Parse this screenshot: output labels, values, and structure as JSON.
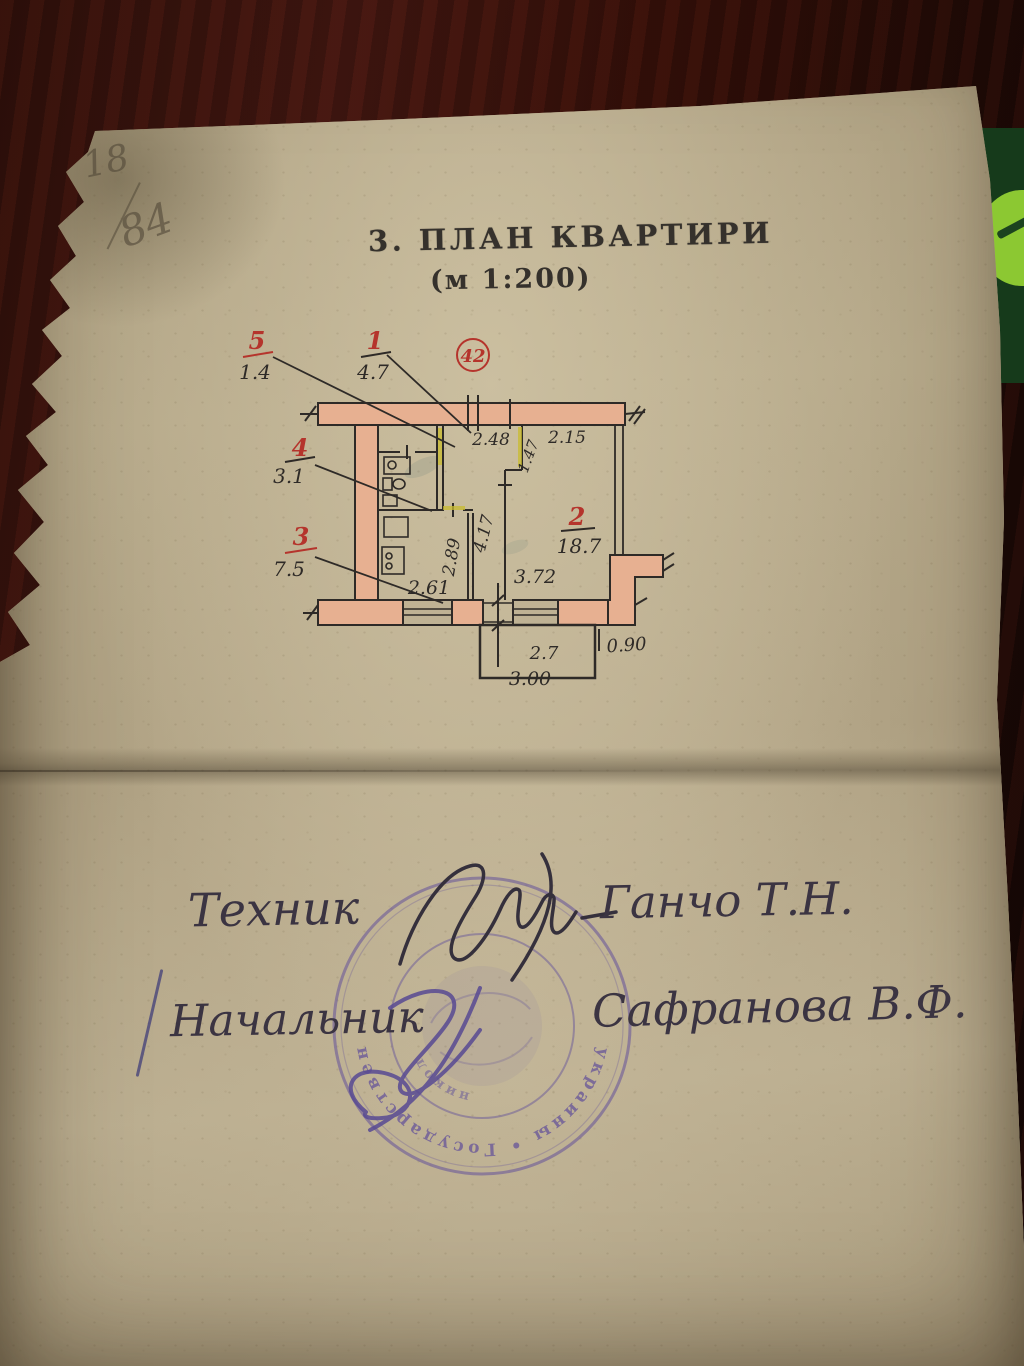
{
  "heading": {
    "title": "3. ПЛАН КВАРТИРИ",
    "scale": "(м 1:200)"
  },
  "corner_note": {
    "top": "18",
    "bottom": "84"
  },
  "plan": {
    "flat_number": "42",
    "rooms": [
      {
        "num": "5",
        "area": "1.4"
      },
      {
        "num": "1",
        "area": "4.7"
      },
      {
        "num": "4",
        "area": "3.1"
      },
      {
        "num": "3",
        "area": "7.5"
      },
      {
        "num": "2",
        "area": "18.7"
      }
    ],
    "dims": {
      "hall_top": "2.48",
      "room_top": "2.15",
      "niche": "1.47",
      "hall_depth": "4.17",
      "kitchen_depth": "2.89",
      "kitchen_width": "2.61",
      "room_bottom": "3.72",
      "balcony_width": "2.7",
      "balcony_outer": "3.00",
      "step": "0.90"
    }
  },
  "signatures": {
    "row1": {
      "role": "Техник",
      "name": "Ганчо Т.Н."
    },
    "row2": {
      "role": "Начальник",
      "name": "Сафранова В.Ф."
    }
  },
  "stamp": {
    "outer_text": "украины  •  Государствен",
    "inner_text": "никол"
  },
  "colors": {
    "paper": "#b2a487",
    "wall_fill": "#e7b091",
    "red_ink": "#b5342c",
    "black_ink": "#2e2a27",
    "stamp_purple": "#5d4b9b",
    "highlight_yellow": "#c9bc2f"
  }
}
